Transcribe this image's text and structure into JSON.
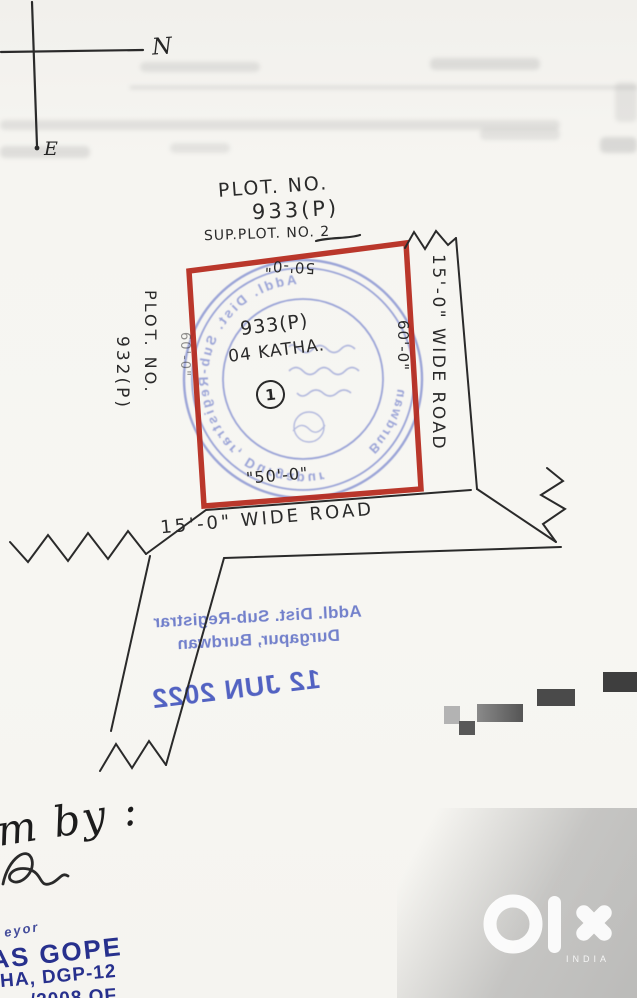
{
  "colors": {
    "paper": "#f7f6f2",
    "ink": "#2a2a2a",
    "plot_red": "#b5281c",
    "seal_blue": "#5f6fc6",
    "office_stamp_blue": "#5b6cc5",
    "date_blue": "#4153bd",
    "surveyor_navy": "#27308d",
    "watermark_white": "#ffffff"
  },
  "compass": {
    "north": "N",
    "east": "E"
  },
  "header": {
    "plot_no_label": "PLOT. NO.",
    "plot_no": "933(P)",
    "sub_plot": "SUP.PLOT. NO. 2"
  },
  "site": {
    "plot_no": "933(P)",
    "area": "04 KATHA.",
    "marker": "1",
    "dim_top": "50'-0\"",
    "dim_bottom": "\"50'-0\"",
    "dim_right": "60'-0\"",
    "dim_left": "60'-0\""
  },
  "adjacent": {
    "plot_no_label": "PLOT. NO.",
    "plot_no": "932(P)"
  },
  "roads": {
    "right": "15'-0\" WIDE ROAD",
    "bottom": "15'-0\" WIDE ROAD"
  },
  "seal": {
    "ring_text": "Addl. Dist. Sub-Registrar, Durgapur",
    "bottom_text": "Burdwan"
  },
  "office_stamp": {
    "line1": "Addl. Dist. Sub-Registrar",
    "line2": "Durgapur, Burdwan",
    "date": "12 JUN 2022"
  },
  "handwriting": {
    "drawn_by": "m by :"
  },
  "surveyor_stamp": {
    "partial_top": "eyor",
    "name": "AS GOPE",
    "line2": "HA, DGP-12",
    "line3": "/2008 OF"
  },
  "watermark": {
    "brand": "olx",
    "country": "INDIA"
  }
}
